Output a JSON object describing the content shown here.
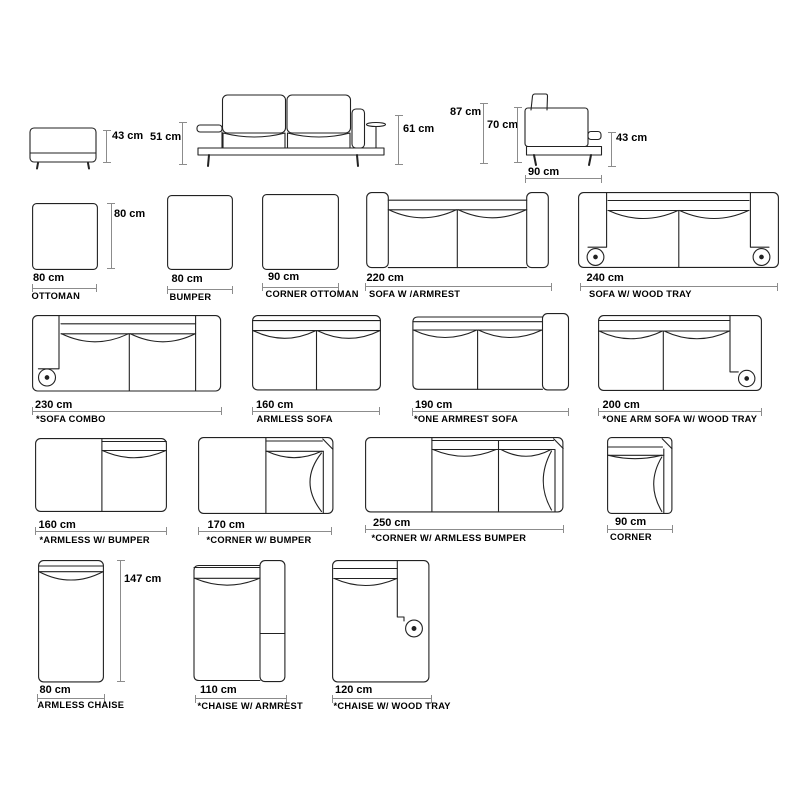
{
  "diagram": {
    "elevations": {
      "ottoman_side": {
        "height": "43 cm"
      },
      "sofa_front": {
        "arm_height": "51 cm",
        "tray_height": "61 cm"
      },
      "sofa_side": {
        "overall_height": "87 cm",
        "back_height": "70 cm",
        "arm_height": "43 cm",
        "depth": "90 cm"
      }
    },
    "modules": [
      {
        "id": "ottoman",
        "name": "OTTOMAN",
        "width": "80 cm",
        "depth": "80 cm"
      },
      {
        "id": "bumper",
        "name": "BUMPER",
        "width": "80 cm"
      },
      {
        "id": "corner-ottoman",
        "name": "CORNER OTTOMAN",
        "width": "90 cm"
      },
      {
        "id": "sofa-w-armrest",
        "name": "SOFA W /ARMREST",
        "width": "220 cm"
      },
      {
        "id": "sofa-w-wood-tray",
        "name": "SOFA W/ WOOD TRAY",
        "width": "240 cm"
      },
      {
        "id": "sofa-combo",
        "name": "*SOFA COMBO",
        "width": "230 cm"
      },
      {
        "id": "armless-sofa",
        "name": "ARMLESS SOFA",
        "width": "160 cm"
      },
      {
        "id": "one-armrest-sofa",
        "name": "*ONE ARMREST SOFA",
        "width": "190 cm"
      },
      {
        "id": "one-arm-sofa-wood-tray",
        "name": "*ONE ARM SOFA W/ WOOD TRAY",
        "width": "200 cm"
      },
      {
        "id": "armless-w-bumper",
        "name": "*ARMLESS W/ BUMPER",
        "width": "160 cm"
      },
      {
        "id": "corner-w-bumper",
        "name": "*CORNER W/ BUMPER",
        "width": "170 cm"
      },
      {
        "id": "corner-armless-bumper",
        "name": "*CORNER W/ ARMLESS BUMPER",
        "width": "250 cm"
      },
      {
        "id": "corner",
        "name": "CORNER",
        "width": "90 cm"
      },
      {
        "id": "armless-chaise",
        "name": "ARMLESS CHAISE",
        "width": "80 cm",
        "length": "147 cm"
      },
      {
        "id": "chaise-w-armrest",
        "name": "*CHAISE W/ ARMREST",
        "width": "110 cm"
      },
      {
        "id": "chaise-w-wood-tray",
        "name": "*CHAISE W/ WOOD TRAY",
        "width": "120 cm"
      }
    ]
  }
}
